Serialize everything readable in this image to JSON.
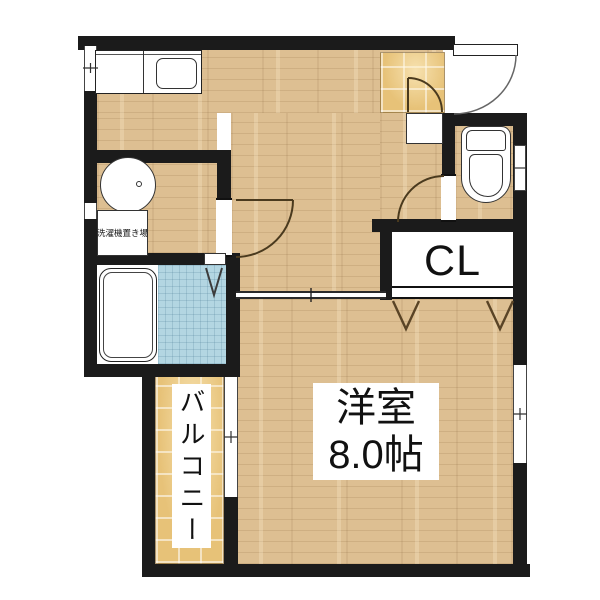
{
  "floorplan": {
    "rooms": {
      "western_room": {
        "name_line1": "洋室",
        "name_line2": "8.0帖"
      },
      "closet": {
        "label": "CL"
      },
      "balcony": {
        "label": "バルコニー"
      },
      "laundry_space": {
        "label": "洗濯機置き場"
      }
    },
    "colors": {
      "wall": "#1b1b1b",
      "wood_floor": "#ddbf92",
      "entry_tile": "#e7c278",
      "bath_tile": "#b3d6e2",
      "door_arc": "#4a3a1e"
    }
  }
}
